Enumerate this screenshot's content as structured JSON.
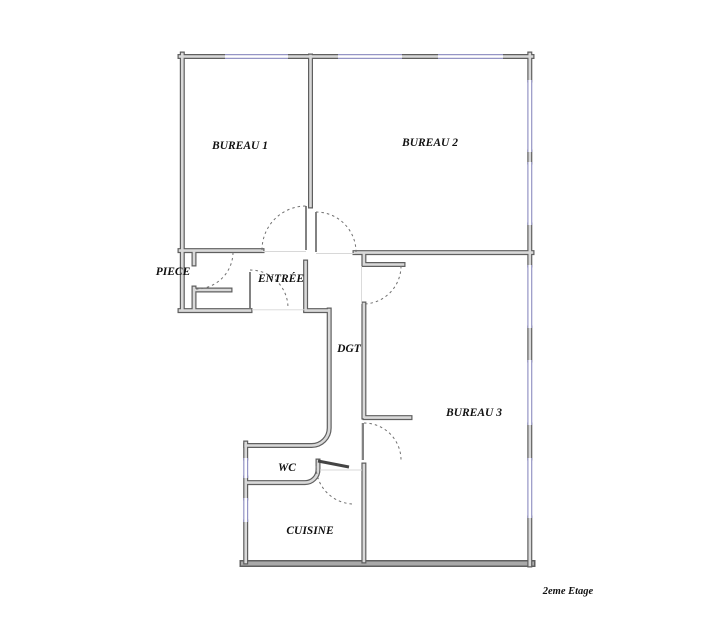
{
  "floor_plan": {
    "caption": "2eme Etage",
    "rooms": {
      "bureau1": "BUREAU 1",
      "bureau2": "BUREAU 2",
      "bureau3": "BUREAU 3",
      "piece": "PIECE",
      "entree": "ENTRÉE",
      "dgt": "DGT",
      "wc": "WC",
      "cuisine": "CUISINE"
    },
    "colors": {
      "wall_edge": "#5f5f5f",
      "wall_core": "#d9d9d9",
      "thick_wall_core": "#a9a9a9",
      "window": "#9595c5",
      "label_text": "#111111",
      "background": "#ffffff"
    }
  }
}
